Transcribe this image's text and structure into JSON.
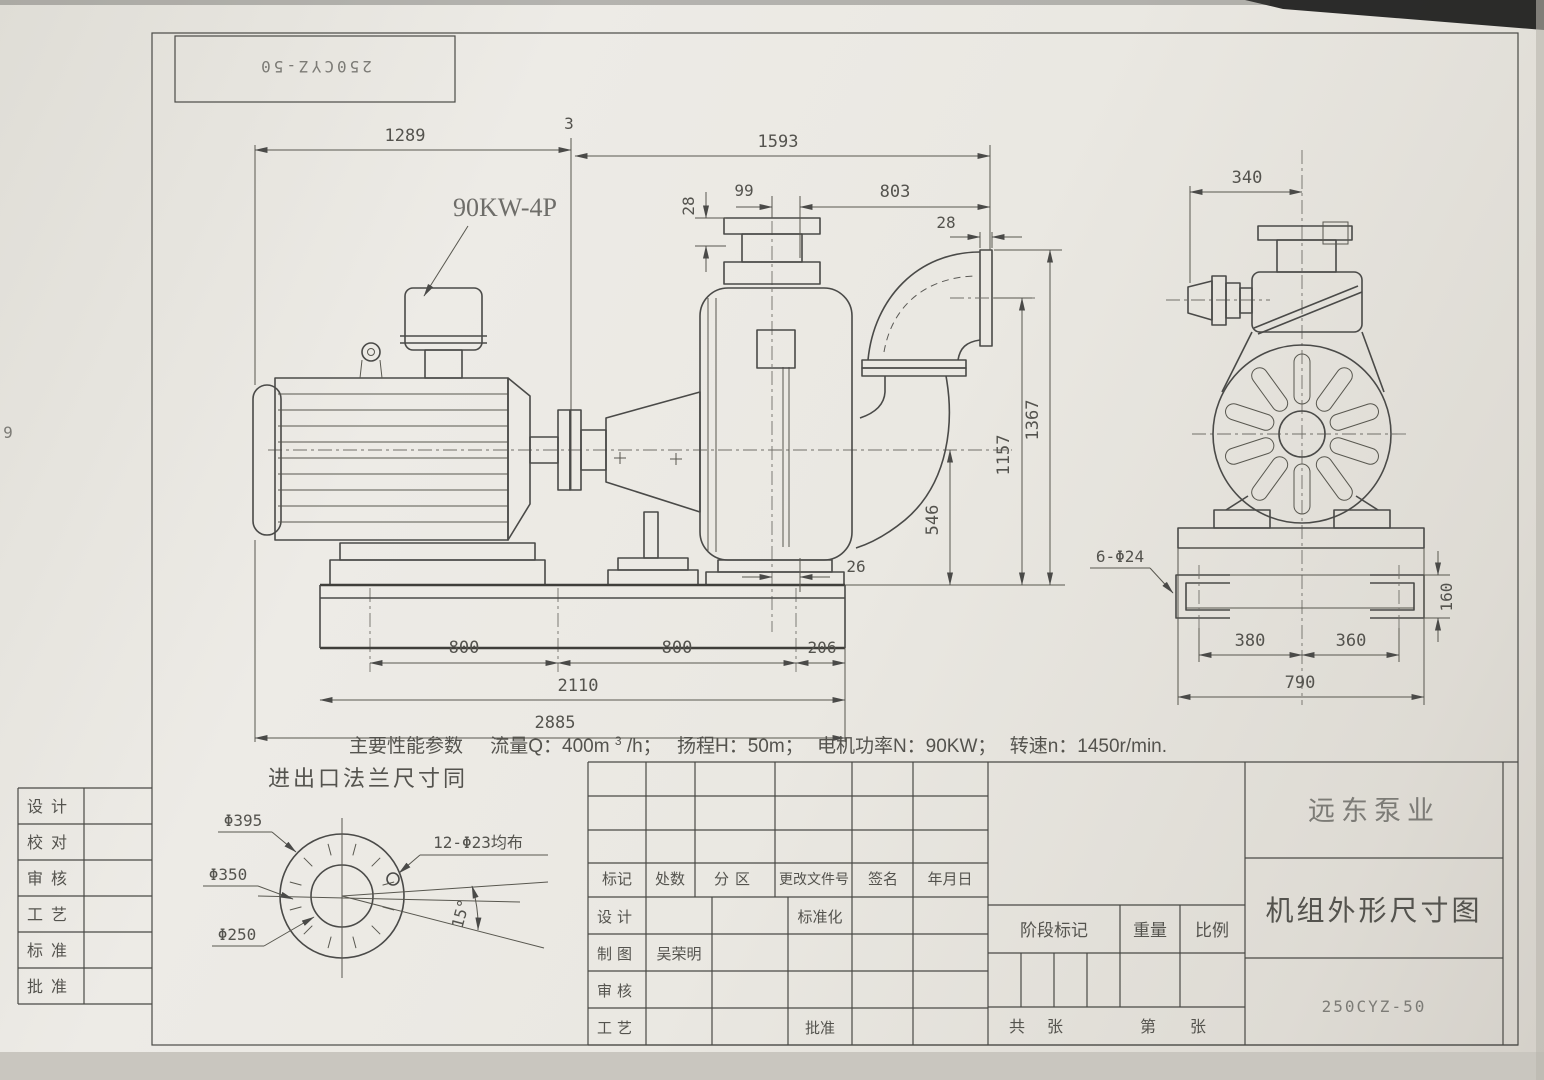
{
  "sheet": {
    "model_top_label": "250CYZ-50",
    "edge_digit": "9",
    "paper_color": "#eae8e2",
    "line_color": "#4a4a48"
  },
  "labels": {
    "motor": "90KW-4P",
    "bolt_note": "6-Φ24"
  },
  "dims": {
    "d1289": "1289",
    "d3": "3",
    "d1593": "1593",
    "d28_inlet": "28",
    "d99": "99",
    "d803": "803",
    "d28_outlet": "28",
    "d1367": "1367",
    "d1157": "1157",
    "d546": "546",
    "d26": "26",
    "d800a": "800",
    "d800b": "800",
    "d206": "206",
    "d2110": "2110",
    "d2885": "2885",
    "d340": "340",
    "d160": "160",
    "d380": "380",
    "d360": "360",
    "d790": "790"
  },
  "flange_detail": {
    "title": "进出口法兰尺寸同",
    "d395": "Φ395",
    "d350": "Φ350",
    "d250": "Φ250",
    "holes": "12-Φ23均布",
    "angle": "15°"
  },
  "performance": {
    "label": "主要性能参数",
    "flow_prefix": "流量Q：400m",
    "flow_sup": "3",
    "flow_suffix": "/h；",
    "head": "扬程H：50m；",
    "power": "电机功率N：90KW；",
    "speed": "转速n：1450r/min."
  },
  "title_block": {
    "company": "远东泵业",
    "drawing_title": "机组外形尺寸图",
    "model": "250CYZ-50",
    "header": [
      "标记",
      "处数",
      "分区",
      "更改文件号",
      "签名",
      "年月日"
    ],
    "row_design": "设计",
    "row_draft": "制图",
    "drafter_name": "吴荣明",
    "row_check": "审核",
    "row_process": "工艺",
    "standardization": "标准化",
    "approve": "批准",
    "stage_mark": "阶段标记",
    "weight": "重量",
    "scale": "比例",
    "total_prefix": "共",
    "total_suffix": "张",
    "no_prefix": "第",
    "no_suffix": "张"
  },
  "left_block": {
    "rows": [
      "设计",
      "校对",
      "审核",
      "工艺",
      "标准",
      "批准"
    ]
  }
}
